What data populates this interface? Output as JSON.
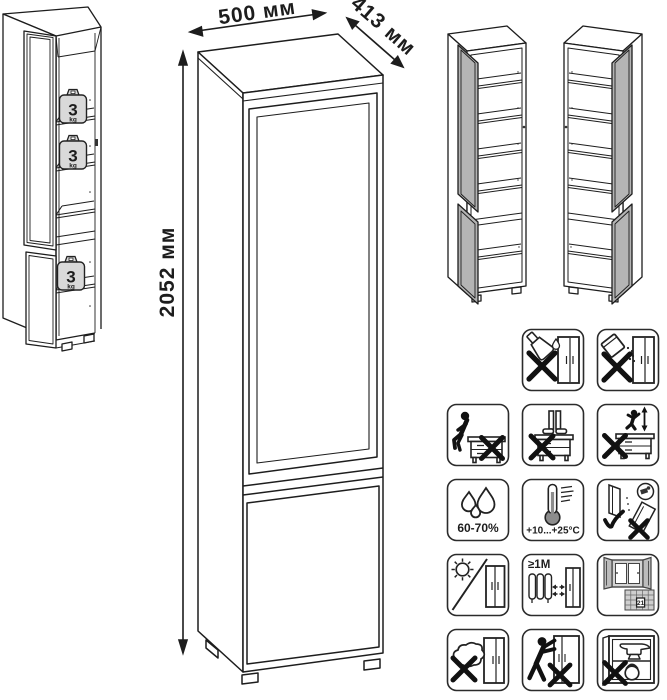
{
  "diagram": {
    "dimensions": {
      "width_label": "500 мм",
      "depth_label": "413 мм",
      "height_label": "2052 мм"
    },
    "shelf_load": {
      "value": "3",
      "unit": "kg"
    },
    "colors": {
      "line": "#1d1d1d",
      "door_fill": "#b4b4b4",
      "weight_fill": "#d9d9d9",
      "thermometer_fill": "#8c8c8c",
      "window_fill": "#cfcfcf"
    }
  },
  "icon_labels": {
    "humidity": "60-70%",
    "temperature": "+10...+25°C",
    "min_distance": "≥1М",
    "calendar_day": "21"
  },
  "icons": [
    "no-liquids-icon",
    "no-powder-icon",
    "no-sitting-icon",
    "no-standing-icon",
    "no-jumping-icon",
    "humidity-range-icon",
    "temperature-range-icon",
    "carry-upright-icon",
    "no-direct-sunlight-icon",
    "heater-distance-icon",
    "ventilated-room-icon",
    "no-wet-cleaning-icon",
    "no-dragging-icon",
    "no-heavy-load-icon"
  ]
}
